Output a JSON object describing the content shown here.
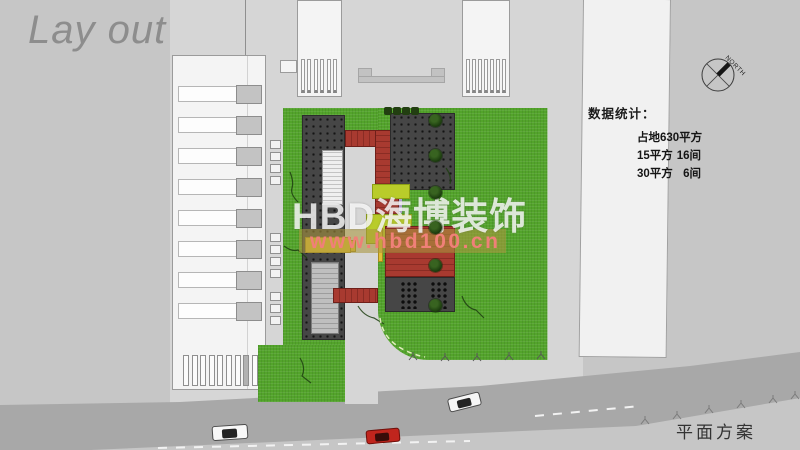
{
  "slide": {
    "title": "Lay out",
    "caption": "平面方案"
  },
  "watermark": {
    "brand": "HBD海博装饰",
    "url": "www.hbd100.cn"
  },
  "compass": {
    "label": "NORTH"
  },
  "stats": {
    "heading": "数据统计：",
    "total": "占地630平方",
    "rows": [
      {
        "size": "15平方",
        "count": "16间"
      },
      {
        "size": "30平方",
        "count": "6间"
      }
    ]
  },
  "colors": {
    "background": "#c6c6c6",
    "plaza": "#d6d6d6",
    "road": "#a8a8a8",
    "lawn": "#53a42b",
    "building_dark": "#464646",
    "roof_red": "#a83a30",
    "accent_yellow": "#e2bf35",
    "accent_chartreuse": "#b9cc2a",
    "watermark_url_color": "#f08078",
    "car_red": "#c0251d"
  }
}
